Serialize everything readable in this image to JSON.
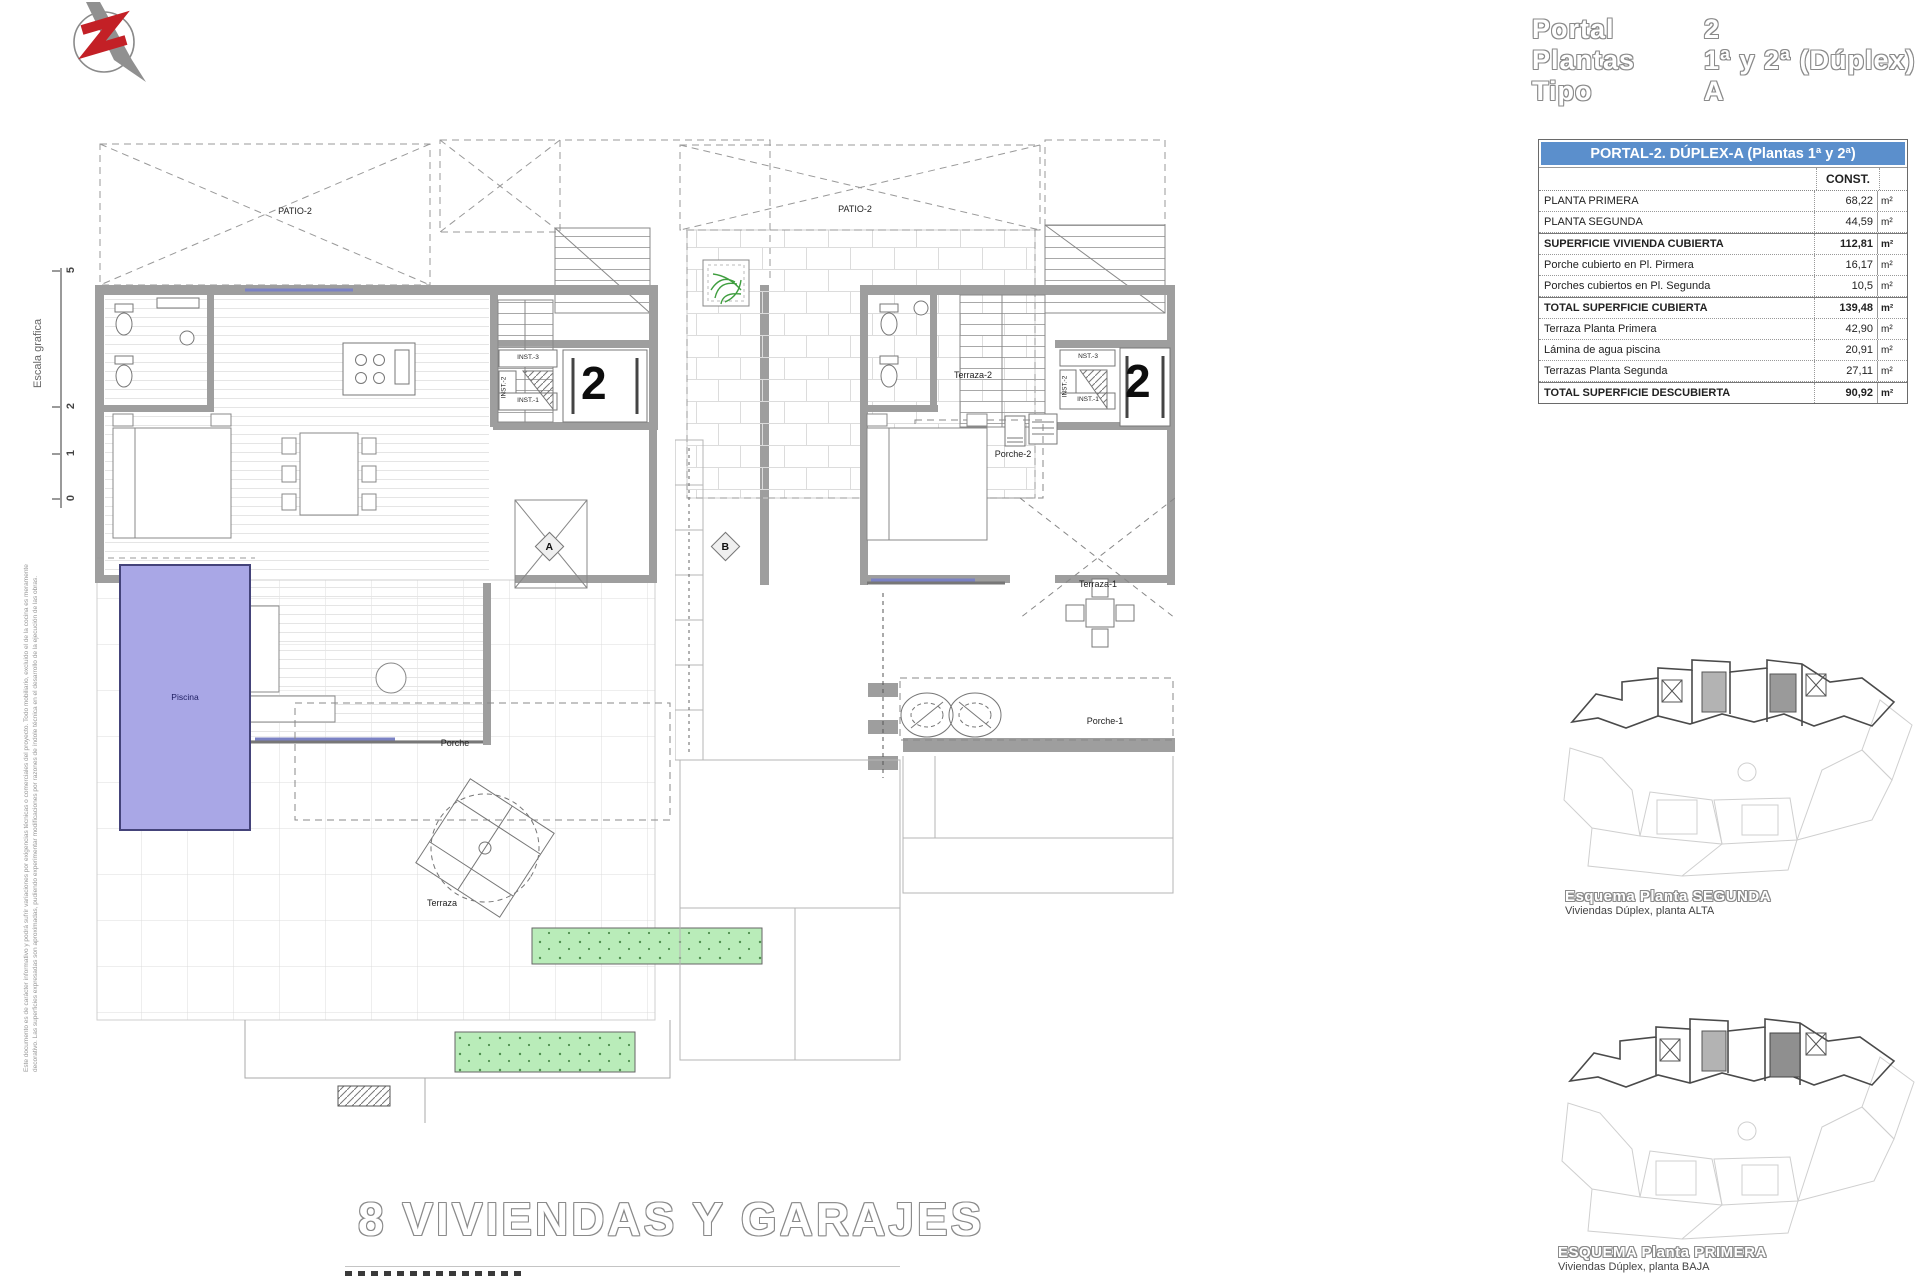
{
  "header": {
    "rows": [
      {
        "label": "Portal",
        "value": "2"
      },
      {
        "label": "Plantas",
        "value": "1ª y 2ª (Dúplex)"
      },
      {
        "label": "Tipo",
        "value": "A"
      }
    ]
  },
  "area_table": {
    "title": "PORTAL-2. DÚPLEX-A (Plantas 1ª y 2ª)",
    "const_header": "CONST.",
    "rows": [
      {
        "label": "PLANTA PRIMERA",
        "value": "68,22",
        "unit": "m²"
      },
      {
        "label": "PLANTA SEGUNDA",
        "value": "44,59",
        "unit": "m²"
      },
      {
        "label": "SUPERFICIE VIVIENDA CUBIERTA",
        "value": "112,81",
        "unit": "m²"
      },
      {
        "label": "Porche cubierto en Pl. Pirmera",
        "value": "16,17",
        "unit": "m²"
      },
      {
        "label": "Porches cubiertos en Pl. Segunda",
        "value": "10,5",
        "unit": "m²"
      },
      {
        "label": "TOTAL SUPERFICIE CUBIERTA",
        "value": "139,48",
        "unit": "m²"
      },
      {
        "label": "Terraza Planta Primera",
        "value": "42,90",
        "unit": "m²"
      },
      {
        "label": "Lámina de agua piscina",
        "value": "20,91",
        "unit": "m²"
      },
      {
        "label": "Terrazas Planta Segunda",
        "value": "27,11",
        "unit": "m²"
      },
      {
        "label": "TOTAL SUPERFICIE DESCUBIERTA",
        "value": "90,92",
        "unit": "m²"
      }
    ]
  },
  "scale_bar": {
    "label": "Escala grafica",
    "ticks": [
      "5",
      "2",
      "1",
      "0"
    ]
  },
  "disclaimer": {
    "line1": "Este documento es de carácter informativo y podrá sufrir variaciones por exigencias técnicas o comerciales del proyecto. Todo mobiliario, excluido el de la cocina es meramente",
    "line2": "decorativo. Las superficies expresadas son aproximadas, pudiendo experimentar modificaciones por razones de índole técnica en el desarrollo de la ejecución de las obras."
  },
  "plan_first": {
    "patio": "PATIO-2",
    "porche": "Porche",
    "piscina": "Piscina",
    "terraza": "Terraza",
    "inst3": "INST.-3",
    "inst2": "INST.-2",
    "inst1": "INST.-1",
    "portal_number": "2",
    "marker_a": "A",
    "marker_b": "B"
  },
  "plan_second": {
    "patio": "PATIO-2",
    "terraza2": "Terraza-2",
    "porche2": "Porche-2",
    "terraza1": "Terraza-1",
    "porche1": "Porche-1",
    "inst3": "NST.-3",
    "inst2": "INST.-2",
    "inst1": "INST.-1",
    "portal_number": "2"
  },
  "site_schematics": [
    {
      "title": "Esquema Planta SEGUNDA",
      "subtitle": "Viviendas Dúplex, planta ALTA"
    },
    {
      "title": "ESQUEMA Planta PRIMERA",
      "subtitle": "Viviendas Dúplex, planta BAJA"
    }
  ],
  "footer": {
    "title": "8 VIVIENDAS Y GARAJES"
  },
  "colors": {
    "pool": "#a9a7e6",
    "planter_green": "#b9ecb9",
    "table_header_bg": "#5b8fcc",
    "wall_gray": "#9e9e9e",
    "logo_red": "#c32026",
    "window_blue": "#7b82c4"
  }
}
